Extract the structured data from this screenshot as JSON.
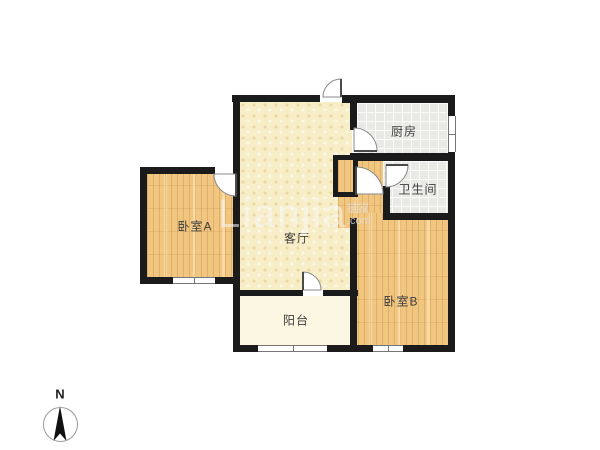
{
  "rooms": {
    "bedroomA": "卧室A",
    "living": "客厅",
    "kitchen": "厨房",
    "bathroom": "卫生间",
    "bedroomB": "卧室B",
    "balcony": "阳台"
  },
  "watermark": {
    "brand": "Lianjia",
    "cn_lines": "链家\n.com"
  },
  "compass": {
    "north": "N"
  },
  "colors": {
    "wall": "#1b1b1b",
    "wood_floor": "#f1c681",
    "living_floor": "#f7edc7",
    "tile_floor": "#e9e9e6",
    "balcony_floor": "#fbf7e3",
    "window_frame": "#767676",
    "door_arc": "#8a8a8a"
  }
}
